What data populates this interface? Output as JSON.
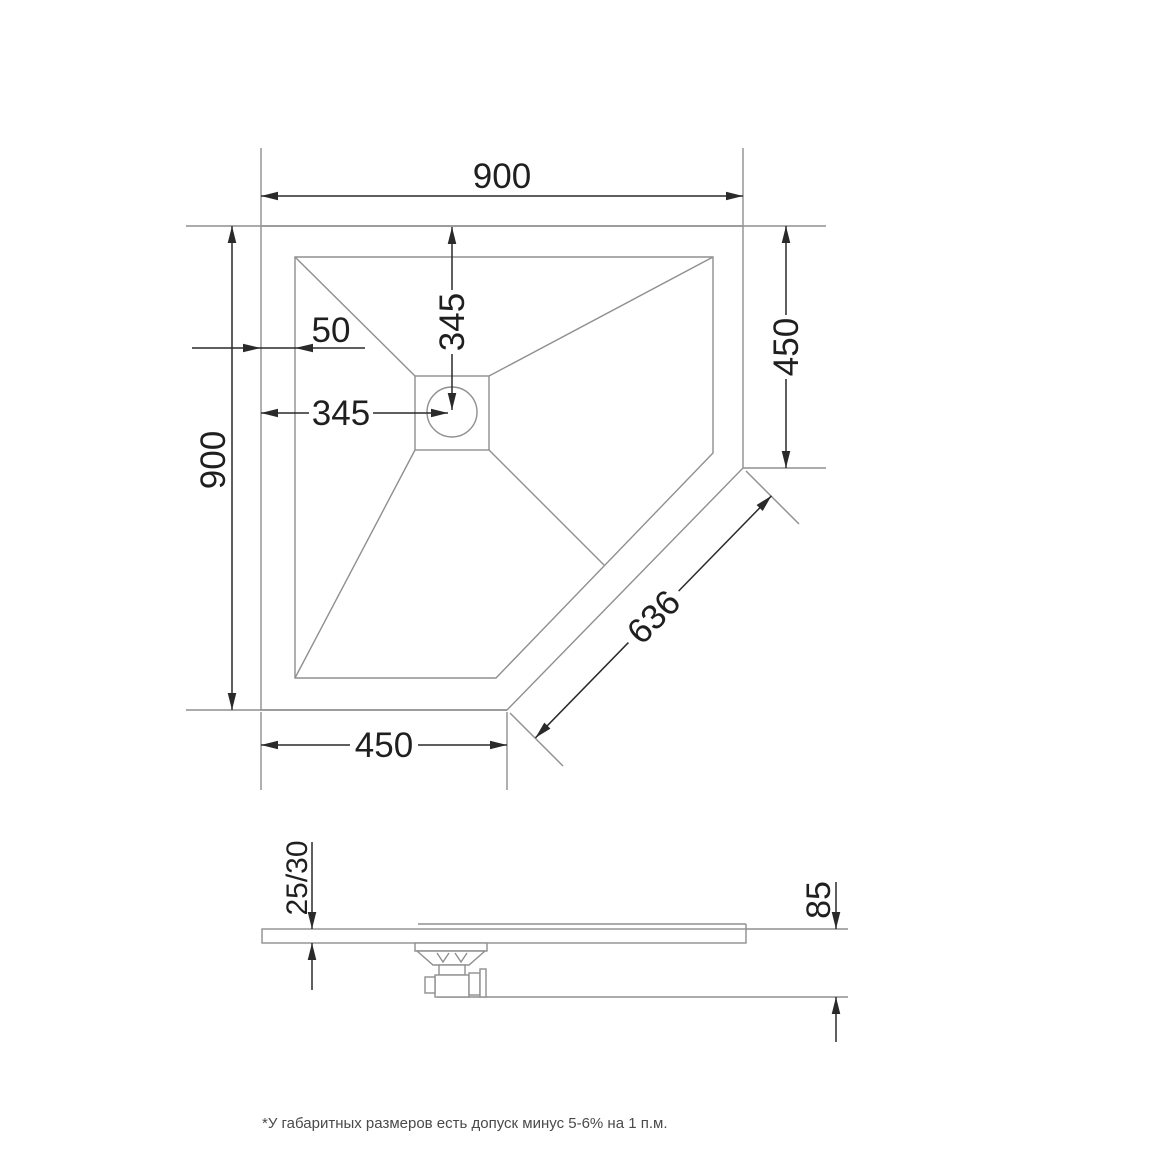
{
  "drawing_type": "shower tray technical drawing, top view and side view",
  "top_view": {
    "overall_width": "900",
    "overall_depth": "900",
    "right_edge": "450",
    "bottom_edge": "450",
    "diagonal_edge": "636",
    "wall_thickness": "50",
    "drain_offset_x": "345",
    "drain_offset_y": "345"
  },
  "side_view": {
    "tray_thickness": "25/30",
    "total_height": "85"
  },
  "footnote": "*У габаритных размеров есть допуск минус  5-6% на 1 п.м.",
  "colors": {
    "geometry_line": "#8f8f8f",
    "dimension_line": "#2a2a2a",
    "dimension_text": "#1f1f1f",
    "footnote_text": "#4a4a4a",
    "background": "#ffffff"
  }
}
